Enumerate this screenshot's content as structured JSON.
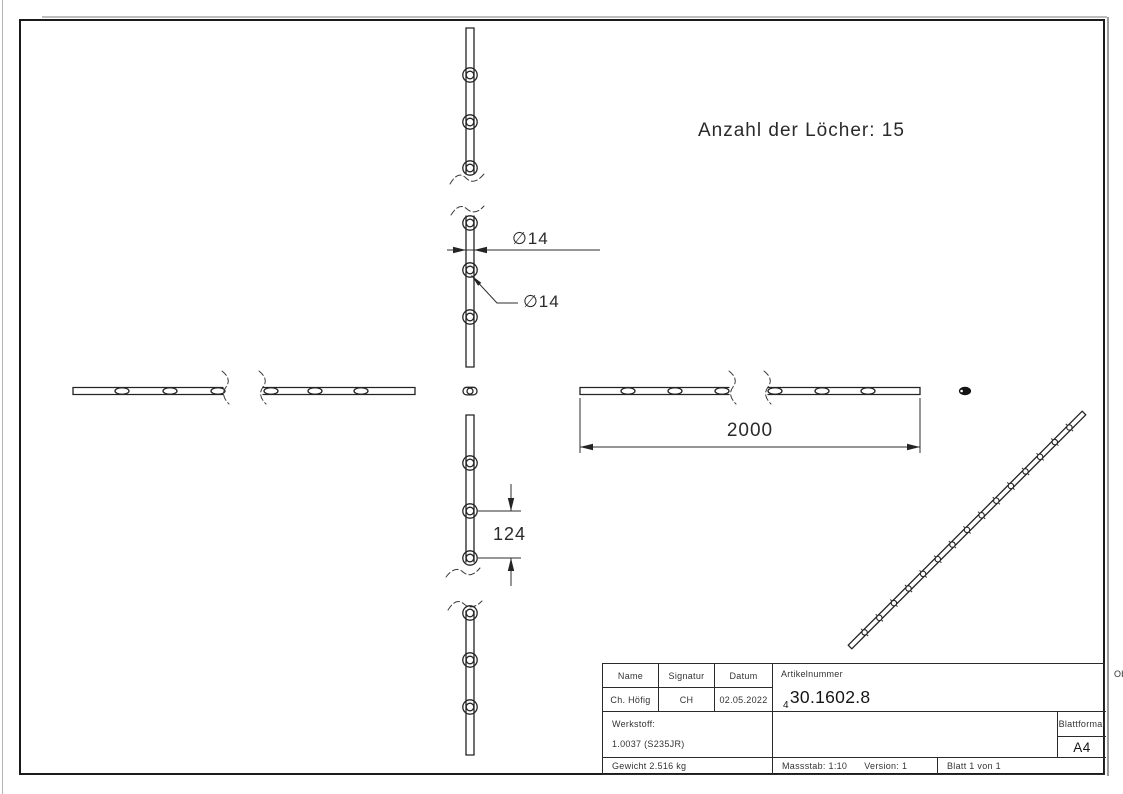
{
  "drawing": {
    "hole_count_note": "Anzahl der Löcher: 15",
    "dim_bar_width": "∅14",
    "dim_hole_dia": "∅14",
    "dim_length": "2000",
    "dim_hole_spacing": "124"
  },
  "title_block": {
    "name_label": "Name",
    "signature_label": "Signatur",
    "date_label": "Datum",
    "name_value": "Ch. Höfig",
    "signature_value": "CH",
    "date_value": "02.05.2022",
    "article_label": "Artikelnummer",
    "article_prefix": "4",
    "article_number": "30.1602.8",
    "surface_label": "Oberfläche:",
    "surface_value": "Roh",
    "material_label": "Werkstoff:",
    "material_value": "1.0037 (S235JR)",
    "weight_value": "Gewicht 2.516 kg",
    "scale_value": "Massstab: 1:10",
    "version_value": "Version: 1",
    "sheet_value": "Blatt 1 von 1",
    "format_label": "Blattformat",
    "format_value": "A4"
  },
  "colors": {
    "line": "#242424",
    "text": "#2a2a2a",
    "fill_dark": "#141414"
  }
}
